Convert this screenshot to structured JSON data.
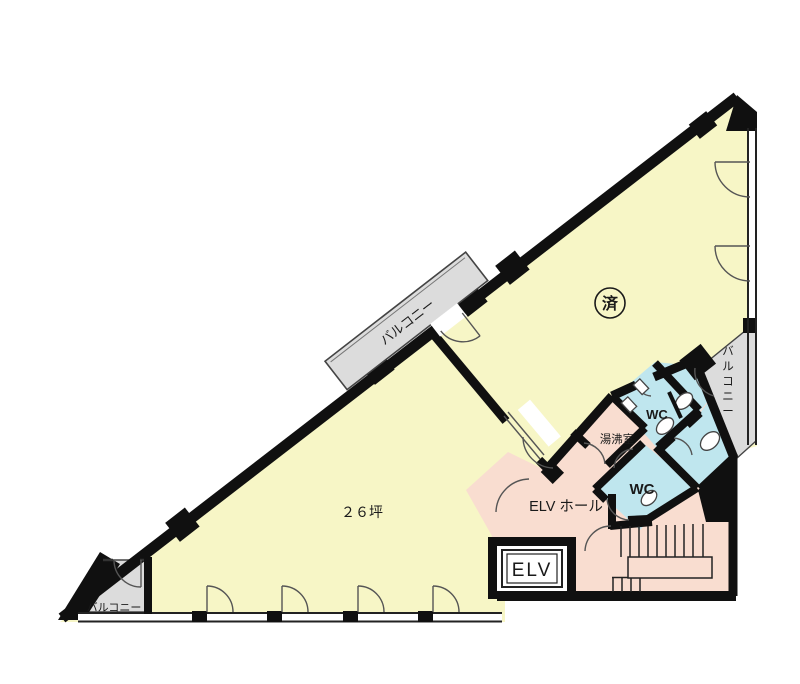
{
  "plan": {
    "stamp": "済",
    "room_area": "２６坪",
    "balcony_middle": "バルコニー",
    "balcony_right": "バルコニー",
    "balcony_bottom_left": "バルコニー",
    "kitchenette": "湯沸室",
    "wc_upper": "WC",
    "wc_lower": "WC",
    "elevator_hall": "ELV ホール",
    "elevator": "ELV",
    "colors": {
      "room_yellow": "#f7f6c6",
      "service_pink": "#f9ddd0",
      "wc_blue": "#bfe6ee",
      "balcony_gray": "#dcdcdc",
      "wall_black": "#101010"
    }
  }
}
